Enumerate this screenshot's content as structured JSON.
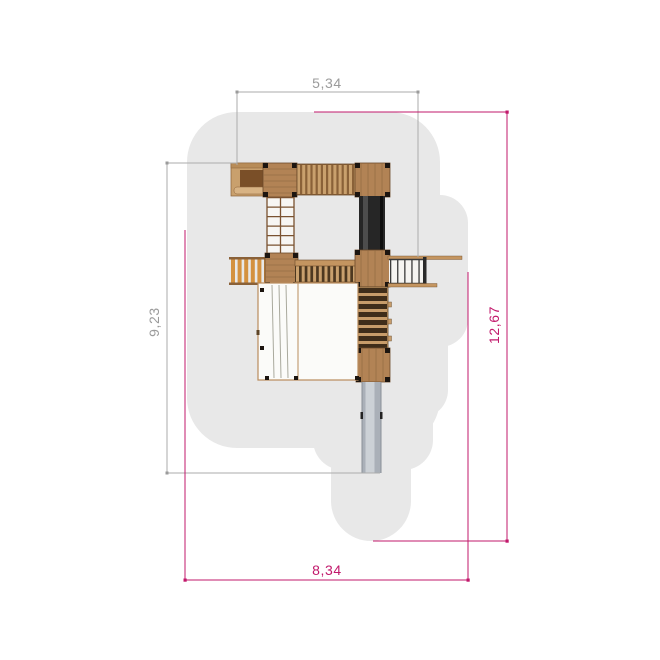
{
  "drawing": {
    "type": "playground-equipment-top-view-plan",
    "dimensions": {
      "top": "5,34",
      "left": "9,23",
      "right": "12,67",
      "bottom": "8,34"
    },
    "colors": {
      "background": "#ffffff",
      "safety_zone_fill": "#e8e8e8",
      "equipment_dimension_color": "#9b9b9b",
      "safety_dimension_color": "#c2186b",
      "wood_light": "#c9a06d",
      "wood_mid": "#b28355",
      "wood_dark": "#8a6138",
      "wood_shadow": "#3f2d1a",
      "rung_orange": "#d4913f",
      "post_black": "#1c1510",
      "tube_black": "#262626",
      "slide_gray": "#aab0b8",
      "slide_gray_light": "#ccd1d6",
      "net_panel_fill": "#fbfbf9"
    }
  }
}
